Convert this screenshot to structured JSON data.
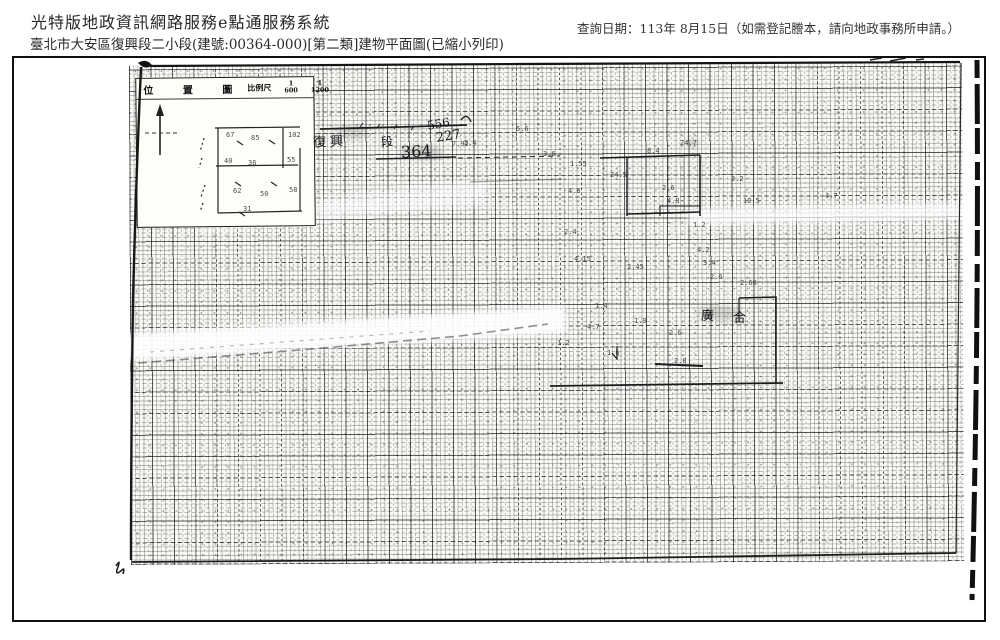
{
  "header": {
    "system_title": "光特版地政資訊網路服務e點通服務系統",
    "query_date": "查詢日期：113年 8月15日（如需登記謄本，請向地政事務所申請。）",
    "subtitle": "臺北市大安區復興段二小段(建號:00364-000)[第二類]建物平面圖(已縮小列印)"
  },
  "scan": {
    "inset": {
      "title": "位 置 圖",
      "scale_label": "比例尺",
      "scale_a_num": "1",
      "scale_a_den": "600",
      "scale_b_num": "1",
      "scale_b_den": "1200"
    },
    "annotations": [
      {
        "text": "復 興",
        "x": 313,
        "y": 131,
        "size": 13,
        "rot": -2
      },
      {
        "text": "段",
        "x": 381,
        "y": 133,
        "size": 12,
        "rot": -6
      },
      {
        "text": "556",
        "x": 427,
        "y": 117,
        "size": 12,
        "rot": -10
      },
      {
        "text": "227",
        "x": 436,
        "y": 129,
        "size": 13,
        "rot": -9
      },
      {
        "text": "364",
        "x": 401,
        "y": 142,
        "size": 16,
        "rot": -3
      },
      {
        "text": "廣",
        "x": 701,
        "y": 305,
        "size": 13,
        "rot": 2
      },
      {
        "text": "合",
        "x": 733,
        "y": 307,
        "size": 13,
        "rot": 0
      }
    ],
    "tiny_marks": [
      {
        "text": "67",
        "x": 226,
        "y": 131
      },
      {
        "text": "85",
        "x": 251,
        "y": 134
      },
      {
        "text": "102",
        "x": 288,
        "y": 131
      },
      {
        "text": "40",
        "x": 224,
        "y": 157
      },
      {
        "text": "36",
        "x": 248,
        "y": 159
      },
      {
        "text": "55",
        "x": 287,
        "y": 156
      },
      {
        "text": "62",
        "x": 233,
        "y": 187
      },
      {
        "text": "50",
        "x": 260,
        "y": 190
      },
      {
        "text": "58",
        "x": 289,
        "y": 186
      },
      {
        "text": "31",
        "x": 243,
        "y": 205
      },
      {
        "text": "7.92",
        "x": 452,
        "y": 140
      },
      {
        "text": "5.6",
        "x": 516,
        "y": 125
      },
      {
        "text": "3.6",
        "x": 543,
        "y": 150
      },
      {
        "text": "2.4",
        "x": 464,
        "y": 139
      },
      {
        "text": "1.55",
        "x": 570,
        "y": 160
      },
      {
        "text": "24.5",
        "x": 610,
        "y": 171
      },
      {
        "text": "4.6",
        "x": 568,
        "y": 187
      },
      {
        "text": "2.4",
        "x": 564,
        "y": 228
      },
      {
        "text": "4.15",
        "x": 574,
        "y": 255
      },
      {
        "text": "8.4",
        "x": 647,
        "y": 147
      },
      {
        "text": "24.7",
        "x": 680,
        "y": 139
      },
      {
        "text": "2.2",
        "x": 731,
        "y": 175
      },
      {
        "text": "10.5",
        "x": 743,
        "y": 197
      },
      {
        "text": "2.6",
        "x": 662,
        "y": 184
      },
      {
        "text": "4.8",
        "x": 667,
        "y": 197
      },
      {
        "text": "1.2",
        "x": 693,
        "y": 221
      },
      {
        "text": "4.2",
        "x": 697,
        "y": 246
      },
      {
        "text": "3.4",
        "x": 703,
        "y": 259
      },
      {
        "text": "2.6",
        "x": 710,
        "y": 273
      },
      {
        "text": "2.45",
        "x": 627,
        "y": 263
      },
      {
        "text": "2.68",
        "x": 740,
        "y": 279
      },
      {
        "text": "4.7",
        "x": 825,
        "y": 192
      },
      {
        "text": "1.4",
        "x": 595,
        "y": 302
      },
      {
        "text": "4.7",
        "x": 587,
        "y": 323
      },
      {
        "text": "1.9",
        "x": 634,
        "y": 317
      },
      {
        "text": "2.6",
        "x": 669,
        "y": 329
      },
      {
        "text": "1.2",
        "x": 557,
        "y": 339
      },
      {
        "text": "1.6",
        "x": 607,
        "y": 349
      },
      {
        "text": "2.8",
        "x": 674,
        "y": 357
      }
    ]
  }
}
